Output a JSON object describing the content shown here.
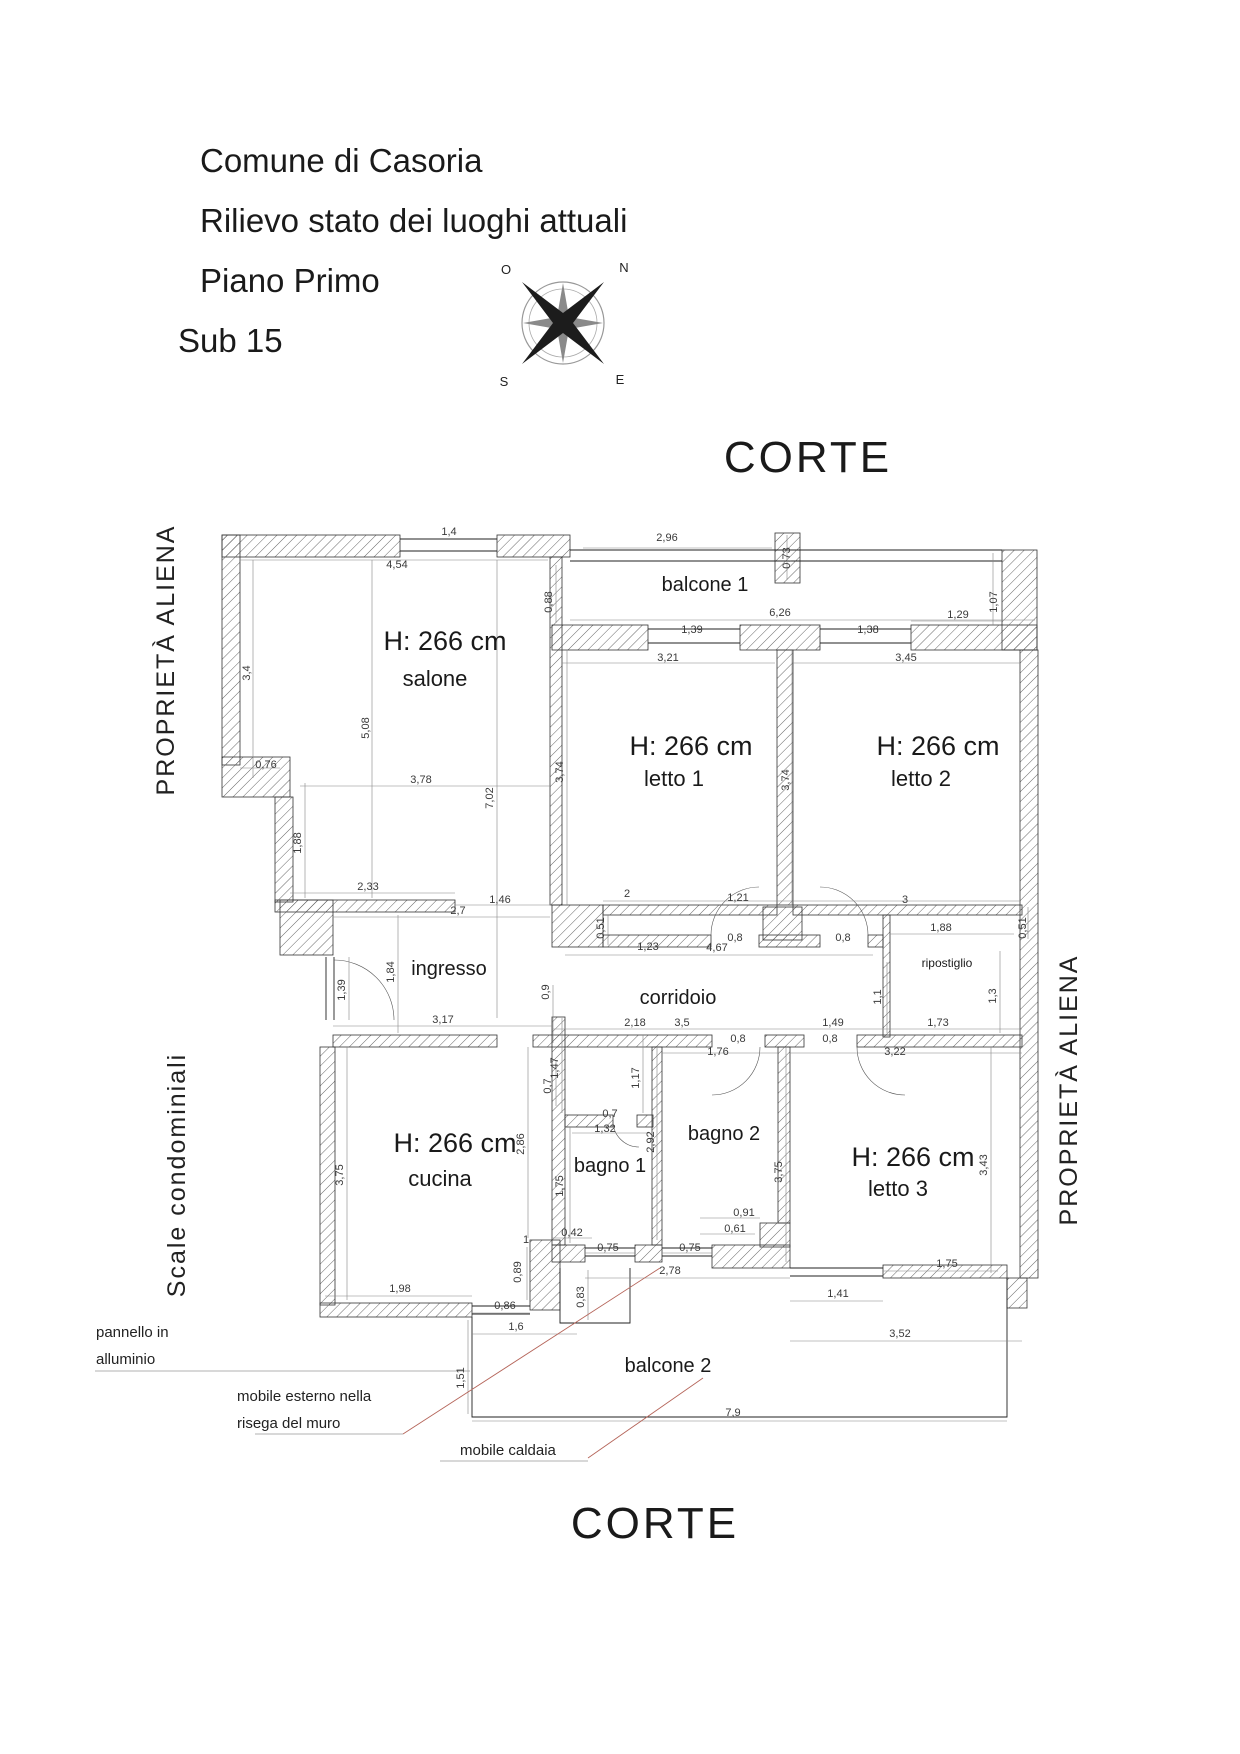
{
  "title_block": {
    "lines": [
      "Comune di Casoria",
      "Rilievo stato dei luoghi attuali",
      "Piano Primo",
      "Sub 15"
    ]
  },
  "compass": {
    "north": "N",
    "south": "S",
    "east": "E",
    "west": "O"
  },
  "site_labels": {
    "corte_top": "CORTE",
    "corte_bottom": "CORTE",
    "left_upper": "PROPRIETÀ ALIENA",
    "left_lower": "Scale condominiali",
    "right": "PROPRIETÀ ALIENA"
  },
  "rooms": [
    {
      "name": "salone",
      "height": "H: 266 cm",
      "hx": 445,
      "hy": 650,
      "nx": 435,
      "ny": 686,
      "cls": "rn"
    },
    {
      "name": "letto 1",
      "height": "H: 266 cm",
      "hx": 691,
      "hy": 755,
      "nx": 674,
      "ny": 786,
      "cls": "rn"
    },
    {
      "name": "letto 2",
      "height": "H: 266 cm",
      "hx": 938,
      "hy": 755,
      "nx": 921,
      "ny": 786,
      "cls": "rn"
    },
    {
      "name": "letto 3",
      "height": "H: 266 cm",
      "hx": 913,
      "hy": 1166,
      "nx": 898,
      "ny": 1196,
      "cls": "rn"
    },
    {
      "name": "cucina",
      "height": "H: 266 cm",
      "hx": 455,
      "hy": 1152,
      "nx": 440,
      "ny": 1186,
      "cls": "rn"
    },
    {
      "name": "balcone 1",
      "nx": 705,
      "ny": 591,
      "cls": "rs"
    },
    {
      "name": "ingresso",
      "nx": 449,
      "ny": 975,
      "cls": "rs"
    },
    {
      "name": "corridoio",
      "nx": 678,
      "ny": 1004,
      "cls": "rs"
    },
    {
      "name": "ripostiglio",
      "nx": 947,
      "ny": 967,
      "cls": "rt"
    },
    {
      "name": "bagno 1",
      "nx": 610,
      "ny": 1172,
      "cls": "rs"
    },
    {
      "name": "bagno 2",
      "nx": 724,
      "ny": 1140,
      "cls": "rs"
    },
    {
      "name": "balcone 2",
      "nx": 668,
      "ny": 1372,
      "cls": "rs"
    }
  ],
  "dimensions": [
    {
      "t": "1,4",
      "x": 449,
      "y": 535
    },
    {
      "t": "4,54",
      "x": 397,
      "y": 568
    },
    {
      "t": "2,96",
      "x": 667,
      "y": 541
    },
    {
      "t": "0,73",
      "x": 790,
      "y": 558,
      "r": 1
    },
    {
      "t": "0,88",
      "x": 552,
      "y": 602,
      "r": 1
    },
    {
      "t": "1,07",
      "x": 997,
      "y": 602,
      "r": 1
    },
    {
      "t": "6,26",
      "x": 780,
      "y": 616
    },
    {
      "t": "1,39",
      "x": 692,
      "y": 633
    },
    {
      "t": "1,38",
      "x": 868,
      "y": 633
    },
    {
      "t": "1,29",
      "x": 958,
      "y": 618
    },
    {
      "t": "3,21",
      "x": 668,
      "y": 661
    },
    {
      "t": "3,45",
      "x": 906,
      "y": 661
    },
    {
      "t": "3,4",
      "x": 250,
      "y": 673,
      "r": 1
    },
    {
      "t": "5,08",
      "x": 369,
      "y": 728,
      "r": 1
    },
    {
      "t": "7,02",
      "x": 493,
      "y": 798,
      "r": 1
    },
    {
      "t": "3,74",
      "x": 563,
      "y": 772,
      "r": 1
    },
    {
      "t": "3,74",
      "x": 789,
      "y": 780,
      "r": 1
    },
    {
      "t": "0,76",
      "x": 266,
      "y": 768
    },
    {
      "t": "1,88",
      "x": 301,
      "y": 843,
      "r": 1
    },
    {
      "t": "2,33",
      "x": 368,
      "y": 890
    },
    {
      "t": "3,78",
      "x": 421,
      "y": 783
    },
    {
      "t": "1,46",
      "x": 500,
      "y": 903
    },
    {
      "t": "2,7",
      "x": 458,
      "y": 914
    },
    {
      "t": "2",
      "x": 627,
      "y": 897
    },
    {
      "t": "1,21",
      "x": 738,
      "y": 901
    },
    {
      "t": "3",
      "x": 905,
      "y": 903
    },
    {
      "t": "0,51",
      "x": 604,
      "y": 928,
      "r": 1
    },
    {
      "t": "0,51",
      "x": 1026,
      "y": 928,
      "r": 1
    },
    {
      "t": "1,23",
      "x": 648,
      "y": 950
    },
    {
      "t": "0,8",
      "x": 735,
      "y": 941
    },
    {
      "t": "0,8",
      "x": 843,
      "y": 941
    },
    {
      "t": "1,88",
      "x": 941,
      "y": 931
    },
    {
      "t": "4,67",
      "x": 717,
      "y": 951
    },
    {
      "t": "0,9",
      "x": 549,
      "y": 992,
      "r": 1
    },
    {
      "t": "1,1",
      "x": 881,
      "y": 997,
      "r": 1
    },
    {
      "t": "1,3",
      "x": 996,
      "y": 996,
      "r": 1
    },
    {
      "t": "1,39",
      "x": 345,
      "y": 990,
      "r": 1
    },
    {
      "t": "1,84",
      "x": 394,
      "y": 972,
      "r": 1
    },
    {
      "t": "3,17",
      "x": 443,
      "y": 1023
    },
    {
      "t": "2,18",
      "x": 635,
      "y": 1026
    },
    {
      "t": "3,5",
      "x": 682,
      "y": 1026
    },
    {
      "t": "1,49",
      "x": 833,
      "y": 1026
    },
    {
      "t": "1,73",
      "x": 938,
      "y": 1026
    },
    {
      "t": "0,8",
      "x": 738,
      "y": 1042
    },
    {
      "t": "0,8",
      "x": 830,
      "y": 1042
    },
    {
      "t": "1,76",
      "x": 718,
      "y": 1055
    },
    {
      "t": "3,22",
      "x": 895,
      "y": 1055
    },
    {
      "t": "1,47",
      "x": 558,
      "y": 1068,
      "r": 1
    },
    {
      "t": "1,17",
      "x": 639,
      "y": 1078,
      "r": 1
    },
    {
      "t": "0,7",
      "x": 551,
      "y": 1086,
      "r": 1
    },
    {
      "t": "0,7",
      "x": 610,
      "y": 1117
    },
    {
      "t": "1,32",
      "x": 605,
      "y": 1132
    },
    {
      "t": "2,92",
      "x": 654,
      "y": 1142,
      "r": 1
    },
    {
      "t": "2,86",
      "x": 524,
      "y": 1144,
      "r": 1
    },
    {
      "t": "3,75",
      "x": 343,
      "y": 1175,
      "r": 1
    },
    {
      "t": "3,75",
      "x": 782,
      "y": 1172,
      "r": 1
    },
    {
      "t": "3,43",
      "x": 987,
      "y": 1165,
      "r": 1
    },
    {
      "t": "1,75",
      "x": 563,
      "y": 1186,
      "r": 1
    },
    {
      "t": "0,42",
      "x": 572,
      "y": 1236
    },
    {
      "t": "0,91",
      "x": 744,
      "y": 1216
    },
    {
      "t": "0,61",
      "x": 735,
      "y": 1232
    },
    {
      "t": "1",
      "x": 526,
      "y": 1243
    },
    {
      "t": "0,89",
      "x": 521,
      "y": 1272,
      "r": 1
    },
    {
      "t": "0,75",
      "x": 608,
      "y": 1251
    },
    {
      "t": "0,75",
      "x": 690,
      "y": 1251
    },
    {
      "t": "2,78",
      "x": 670,
      "y": 1274
    },
    {
      "t": "1,75",
      "x": 947,
      "y": 1267
    },
    {
      "t": "1,98",
      "x": 400,
      "y": 1292
    },
    {
      "t": "0,86",
      "x": 505,
      "y": 1309
    },
    {
      "t": "0,83",
      "x": 584,
      "y": 1297,
      "r": 1
    },
    {
      "t": "1,41",
      "x": 838,
      "y": 1297
    },
    {
      "t": "3,52",
      "x": 900,
      "y": 1337
    },
    {
      "t": "1,6",
      "x": 516,
      "y": 1330
    },
    {
      "t": "1,51",
      "x": 464,
      "y": 1378,
      "r": 1
    },
    {
      "t": "7,9",
      "x": 733,
      "y": 1416
    }
  ],
  "annotations": [
    {
      "lines": [
        "pannello in",
        "alluminio"
      ],
      "x": 96,
      "y": 1337
    },
    {
      "lines": [
        "mobile esterno nella",
        "risega del muro"
      ],
      "x": 237,
      "y": 1401
    },
    {
      "lines": [
        "mobile caldaia"
      ],
      "x": 460,
      "y": 1455
    }
  ],
  "colors": {
    "line": "#1a1a1a",
    "dim_text": "#3a3a3a",
    "leader": "#b5655a",
    "hatch": "#555555"
  }
}
